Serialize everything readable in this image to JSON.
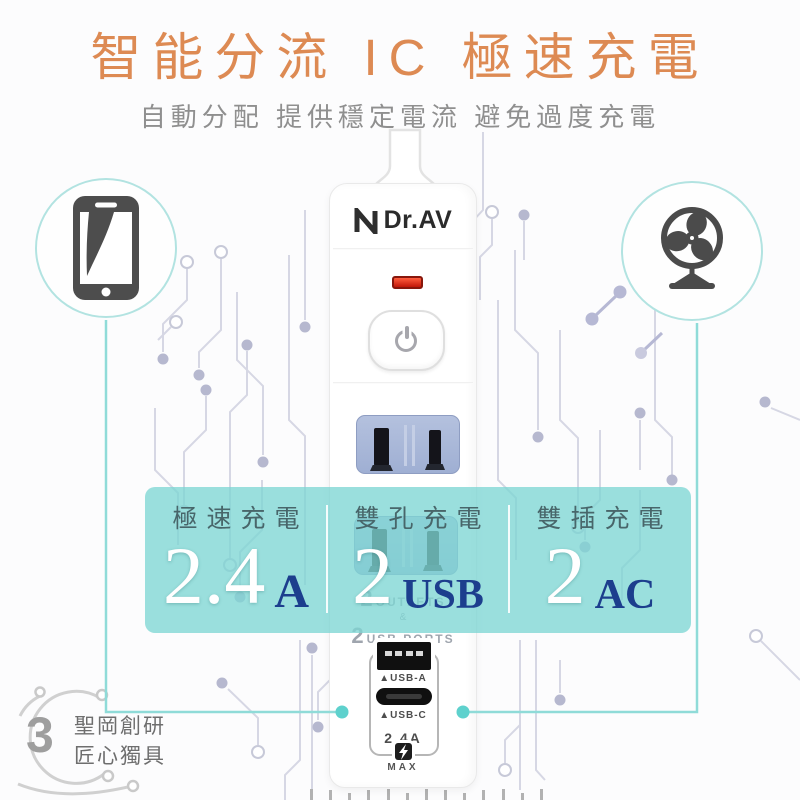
{
  "header": {
    "title": "智能分流 IC 極速充電",
    "subtitle": "自動分配 提供穩定電流 避免過度充電"
  },
  "colors": {
    "title_orange": "#dd8a53",
    "subtitle_gray": "#8f8f8f",
    "band_teal": "#7dd6d3",
    "unit_navy": "#1c3e8d",
    "connector_teal": "#8fdbd8",
    "circuit_lavender": "#d6d7e4",
    "led_red": "#d92c14"
  },
  "icons": {
    "left": "smartphone-icon",
    "right": "fan-icon",
    "power": "power-icon",
    "bolt": "lightning-icon"
  },
  "product": {
    "brand": "Dr.AV",
    "print": {
      "big1": "2",
      "text1": "OUTLETS",
      "amp": "&",
      "big2": "2",
      "text2": "USB PORTS"
    },
    "usb_a_label": "▲USB-A",
    "usb_c_label": "▲USB-C",
    "amp_label": "2.4A",
    "max_label": "MAX"
  },
  "band": {
    "columns": [
      {
        "label": "極速充電",
        "value": "2.4",
        "unit": "A"
      },
      {
        "label": "雙孔充電",
        "value": "2",
        "unit": "USB"
      },
      {
        "label": "雙插充電",
        "value": "2",
        "unit": "AC"
      }
    ]
  },
  "footer": {
    "number": "3",
    "line1": "聖岡創研",
    "line2": "匠心獨具"
  }
}
